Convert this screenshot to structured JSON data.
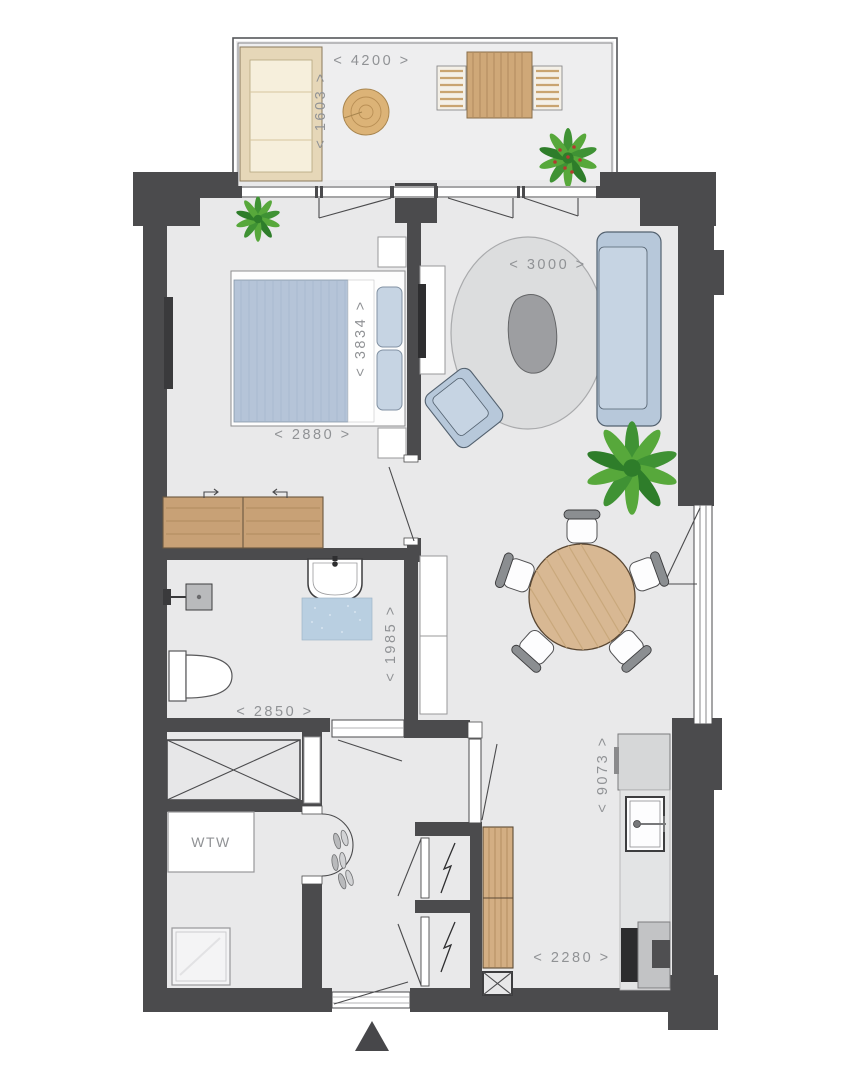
{
  "plan": {
    "kind": "apartment-floor-plan",
    "labels": {
      "balcony_width": "< 4200 >",
      "balcony_depth": "< 1603 >",
      "rug_diameter": "< 3000 >",
      "bedroom_depth": "< 3834 >",
      "bedroom_width": "< 2880 >",
      "bathroom_width": "< 2850 >",
      "bathroom_depth": "< 1985 >",
      "living_depth": "< 9073 >",
      "kitchen_width": "< 2280 >",
      "wtw_unit": "WTW"
    }
  },
  "colors": {
    "wall": "#4b4b4d",
    "floor": "#e9e9ea",
    "balcony_floor": "#eeeeef",
    "label": "#909295",
    "wood": "#c8a176",
    "wood_light": "#d8b893",
    "duvet": "#b5c4d8",
    "sofa": "#b7c8da",
    "sofa_seat": "#c6d4e3",
    "rug": "#dcddde",
    "bath_mat": "#b9cfe1",
    "plant_green": "#459334",
    "berry_red": "#b23b30"
  }
}
